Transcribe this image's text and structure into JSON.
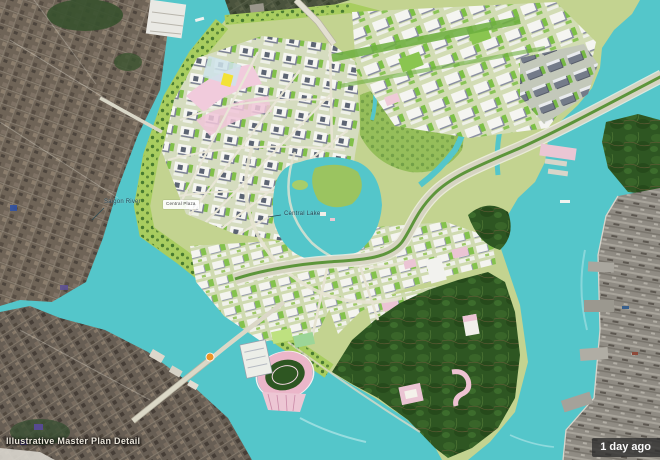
{
  "caption": {
    "text": "Illustrative Master Plan Detail"
  },
  "badge": {
    "text": "1 day ago"
  },
  "labels": {
    "river": "Saigon River",
    "plaza": "Central Plaza",
    "lake": "Central Lake"
  },
  "colors": {
    "water": "#58c5c9",
    "satellite": "#6f6458",
    "satellite_dark": "#675e55",
    "port": "#8f8b83",
    "plan_land": "#c3d393",
    "park": "#a9cc63",
    "bright_park": "#b9d977",
    "wetland": "#2f5524",
    "road": "#d6d4c2",
    "boulevard_median": "#5f943e",
    "block_white": "#f4f4f0",
    "pink": "#f0cbdc",
    "yellow": "#f2e23e",
    "orange": "#e8962e",
    "badge_bg": "rgba(47,47,47,0.8)",
    "badge_text": "#fafafa",
    "caption_text": "#ece7dc",
    "label_text": "#1e3f4e"
  }
}
